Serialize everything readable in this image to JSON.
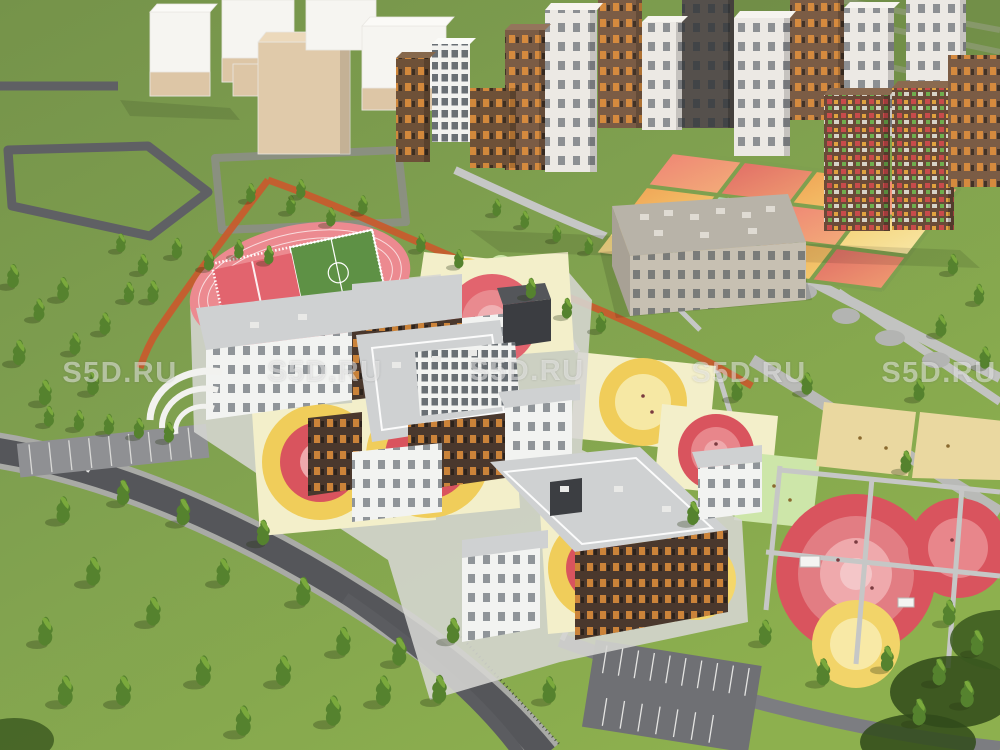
{
  "watermark": {
    "text": "S5D.RU",
    "repeat_count": 5
  },
  "scene": {
    "kind": "aerial-3d-architectural-render",
    "areas": [
      "residential-district",
      "residential-courtyard",
      "kindergarten-building",
      "school-campus",
      "stadium",
      "playgrounds",
      "park-lawn",
      "roads"
    ]
  },
  "palette": {
    "grass_dark": "#75934a",
    "grass_mid": "#7fa04f",
    "grass_bright": "#8db04e",
    "grass_dull": "#6d8a46",
    "road_dark": "#55565a",
    "road_mid": "#7c7d81",
    "path_light": "#c6c7c6",
    "sidewalk": "#a9aaa6",
    "concrete": "#d8d8d5",
    "track_pink": "#ec8a90",
    "court_red": "#e2646e",
    "pitch_green": "#5e9145",
    "play_yellow": "#f0cd5a",
    "play_yellow_pale": "#f6e8a4",
    "play_red": "#d9545e",
    "play_pink": "#efa9ac",
    "play_pale": "#f3efca",
    "play_sand": "#ead8a0",
    "play_mint": "#cde6a9",
    "play_orange": "#f0a155",
    "play_salmon": "#ee8274",
    "facade_white": "#f2f3f1",
    "facade_brown": "#4a382d",
    "facade_brown2": "#6e5138",
    "window_orange": "#e09040",
    "roof_gray": "#cfd1d2",
    "graphite": "#3b3d41",
    "massing_white": "#f6f5f1",
    "massing_beige": "#ddc6a6",
    "jog_orange": "#c95a2d"
  }
}
